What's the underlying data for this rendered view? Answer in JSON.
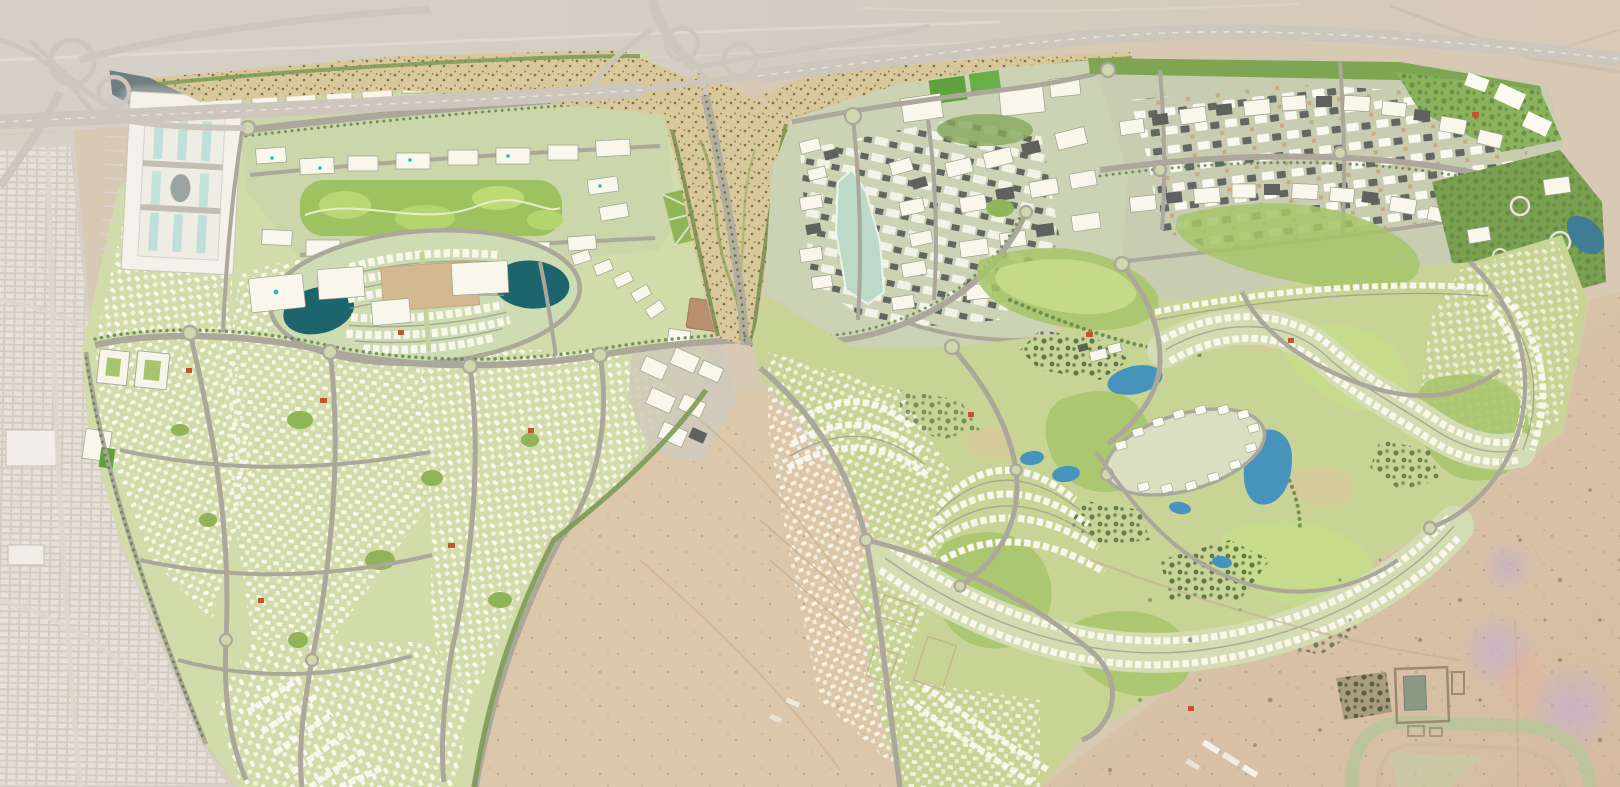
{
  "meta": {
    "type": "aerial-masterplan-render",
    "description": "Top-down aerial rendering of a large desert master-planned community: two developed districts separated by a highway interchange and a landscaped wadi corridor; dense villa neighborhoods, a regional mall, apartment districts, an oval townhouse cluster with twin lakes, and a golf-course community with lakes, all bordered by open desert and an existing city grid to the west.",
    "width_px": 1620,
    "height_px": 787,
    "visible_text": ""
  },
  "palette": {
    "desert_sand": "#d7c9b3",
    "desert_grey": "#d5cfc8",
    "desert_pink": "#dcc3a7",
    "desert_wedge": "#dcc7ab",
    "city_grey": "#d6d0c6",
    "city_block": "#e9e4db",
    "green_base": "#d2dcaa",
    "green_district": "#ccd6ab",
    "green_dark": "#5f7f45",
    "green_park": "#9ec25f",
    "lawn": "#b9d873",
    "golf_base": "#c8d495",
    "fairway": "#a6c468",
    "fairway_light": "#c5dc8b",
    "trees_dark": "#44613a",
    "road_grey": "#aba79a",
    "highway_grey": "#ccc6bc",
    "building_white": "#f9f7ec",
    "roof_grey": "#5e615e",
    "roof_tan": "#c9a87c",
    "roof_red": "#c2552f",
    "water_dark_teal": "#1e646d",
    "water_blue": "#4694bb",
    "water_pale": "#bdd9c8",
    "pond_grey": "#6f7e7f",
    "water_navy": "#3f7d94",
    "scrub_tan": "#d8c79a",
    "scrub_olive": "#7a7442",
    "haze_violet": "#b9a8e2",
    "pitch_green": "#5ea23f"
  },
  "regions": [
    {
      "id": "existing-city-west",
      "label": "existing city grid (west edge)"
    },
    {
      "id": "west-interchange",
      "label": "highway interchange (top left)"
    },
    {
      "id": "main-highway",
      "label": "main highway along north edge"
    },
    {
      "id": "central-interchange",
      "label": "central cloverleaf interchange"
    },
    {
      "id": "wadi-corridor",
      "label": "landscaped wadi corridor with spine boulevard"
    },
    {
      "id": "left-community",
      "label": "western villa community"
    },
    {
      "id": "mall-complex",
      "label": "regional mall with pond"
    },
    {
      "id": "north-apartment-district",
      "label": "northern apartment district with linear park"
    },
    {
      "id": "oval-townhouse-cluster",
      "label": "oval townhouse cluster with twin teal lakes"
    },
    {
      "id": "office-cluster",
      "label": "office cluster on desert edge"
    },
    {
      "id": "right-urban-district",
      "label": "eastern urban district with pale lagoon"
    },
    {
      "id": "schools-cluster",
      "label": "schools with green sports fields"
    },
    {
      "id": "northeast-apartment-band",
      "label": "north-east apartment band"
    },
    {
      "id": "east-park",
      "label": "eastern park with dark lagoon"
    },
    {
      "id": "golf-community",
      "label": "golf-course community with lakes and villa crescents"
    },
    {
      "id": "mansion-cluster",
      "label": "large-villa oval cluster"
    },
    {
      "id": "central-desert-parcel",
      "label": "undeveloped desert parcel (centre-south)"
    },
    {
      "id": "southeast-desert",
      "label": "south-east desert with racetrack, farm compounds and violet haze"
    }
  ]
}
